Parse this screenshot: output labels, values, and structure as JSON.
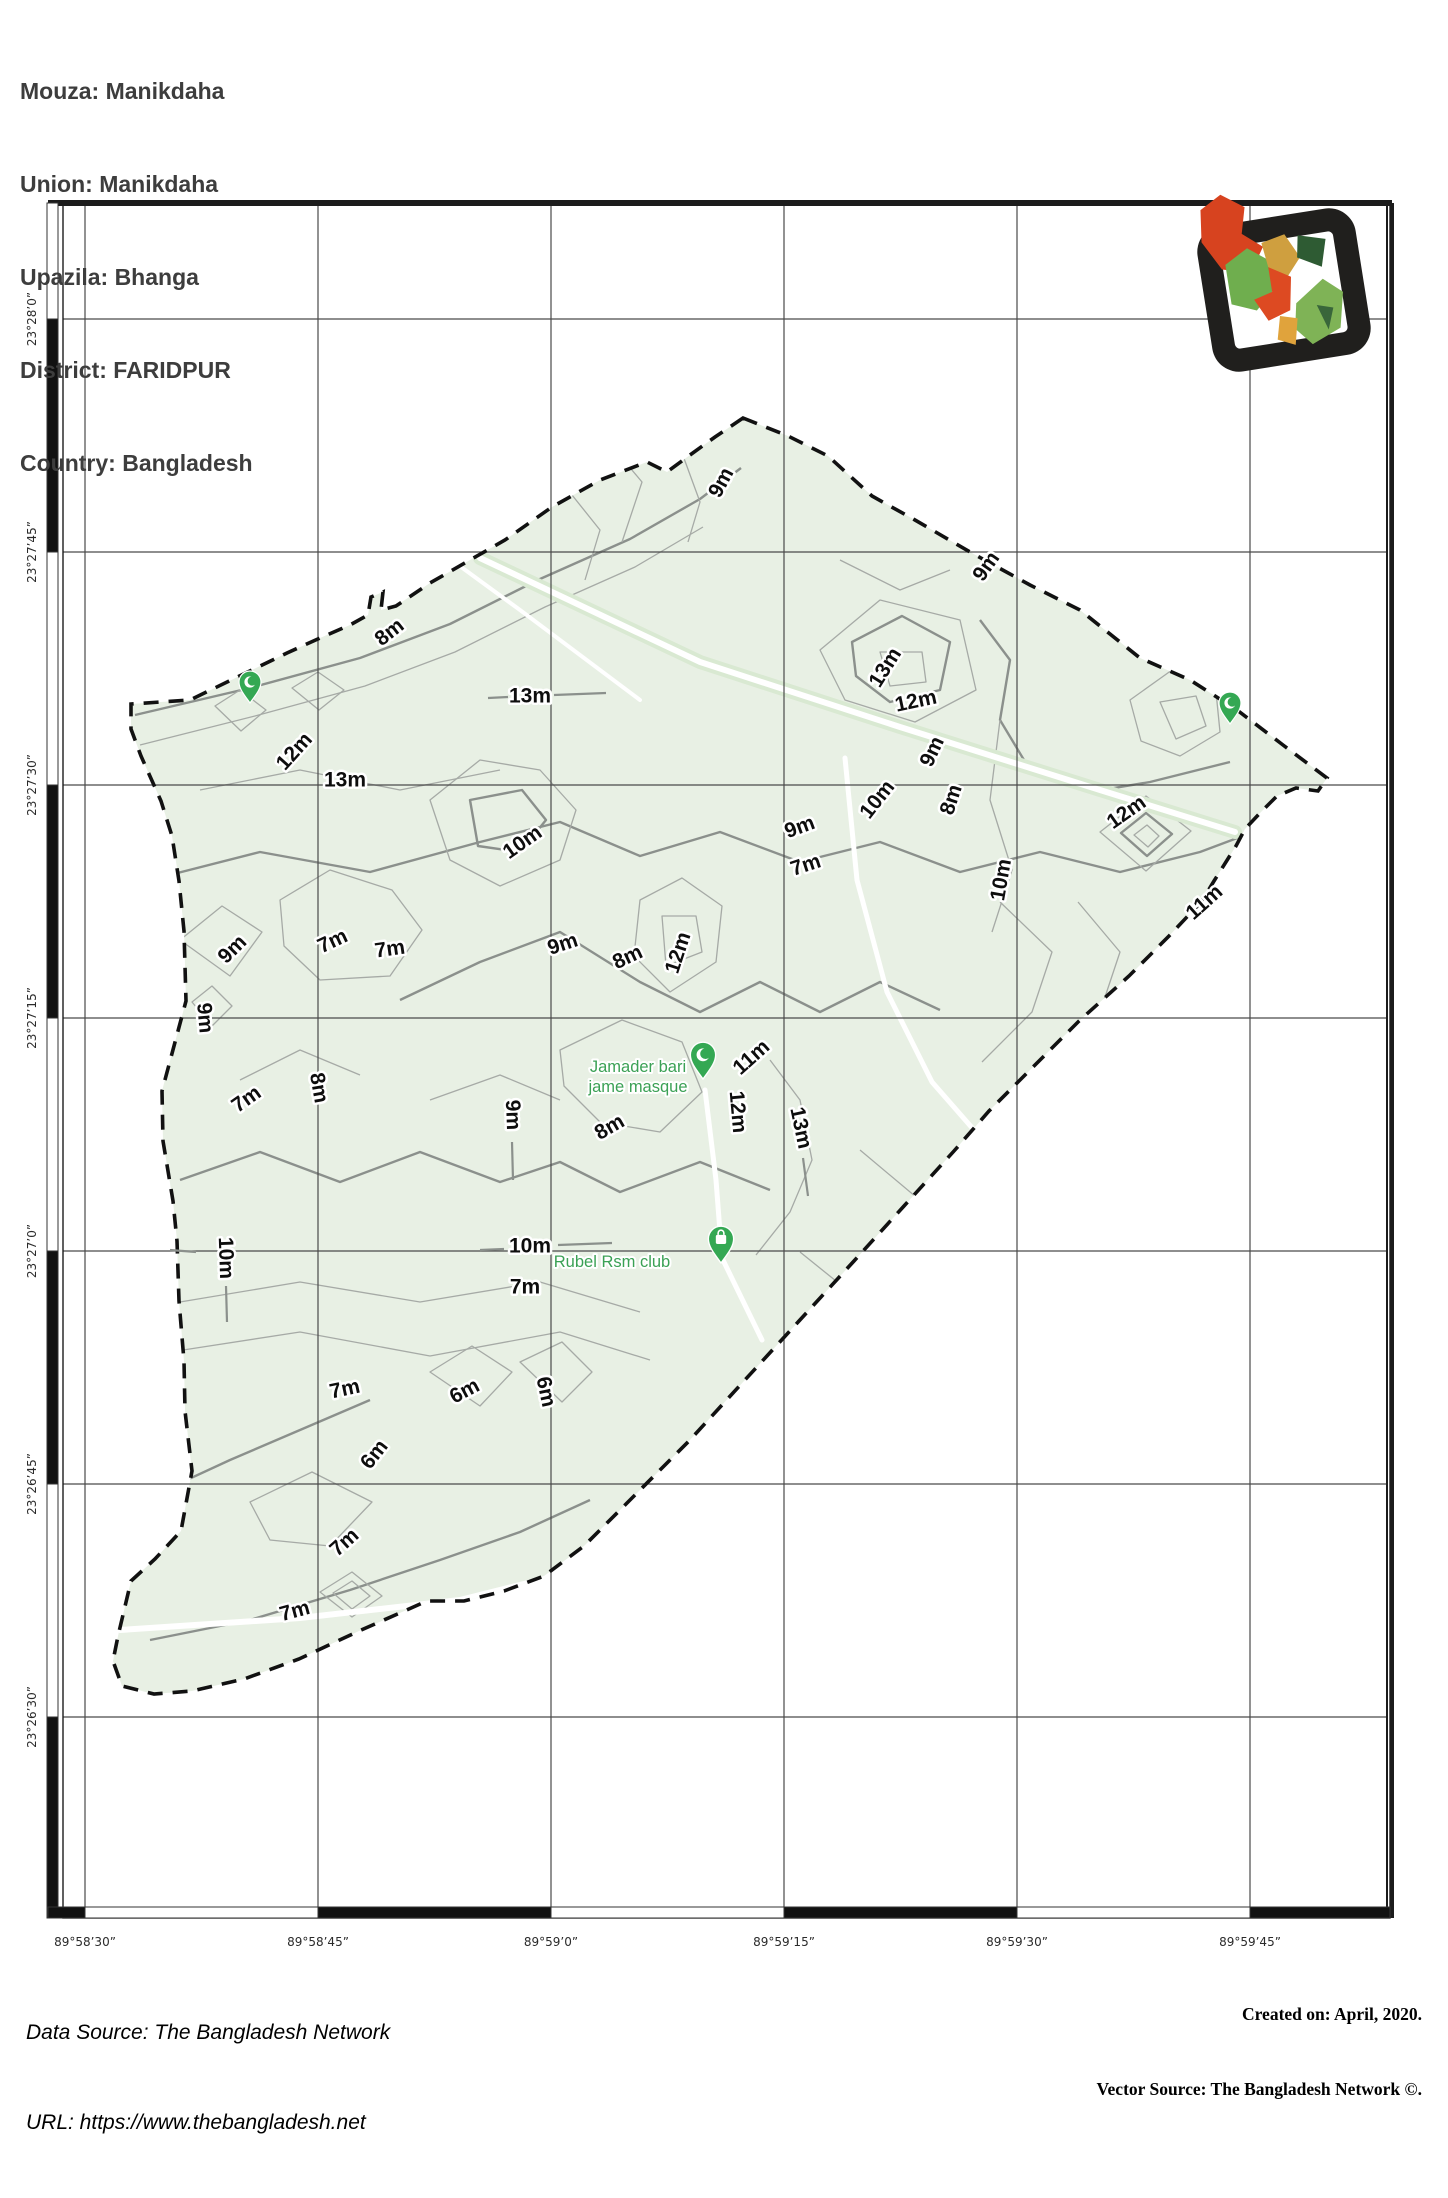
{
  "header": {
    "mouza": "Mouza: Manikdaha",
    "union": "Union: Manikdaha",
    "upazila": "Upazila: Bhanga",
    "district": "District: FARIDPUR",
    "country": "Country: Bangladesh"
  },
  "footer": {
    "data_source": "Data Source: The Bangladesh Network",
    "url": "URL: https://www.thebangladesh.net",
    "created_on": "Created on: April, 2020.",
    "vector_source": "Vector Source: The Bangladesh Network ©."
  },
  "colors": {
    "mouza_fill": "#e8f0e4",
    "contour_thin": "#a6aaa6",
    "contour_thick": "#8b908c",
    "grid": "#4a4a4a",
    "boundary": "#111111",
    "pin_green": "#34a853",
    "poi_text_green": "#3ba155",
    "frame": "#1c1c1c"
  },
  "axes": {
    "lon_ticks": [
      {
        "label": "89°58’30”",
        "x": 85
      },
      {
        "label": "89°58’45”",
        "x": 318
      },
      {
        "label": "89°59’0”",
        "x": 551
      },
      {
        "label": "89°59’15”",
        "x": 784
      },
      {
        "label": "89°59’30”",
        "x": 1017
      },
      {
        "label": "89°59’45”",
        "x": 1250
      }
    ],
    "lat_ticks": [
      {
        "label": "23°28’0”",
        "y": 319
      },
      {
        "label": "23°27’45”",
        "y": 552
      },
      {
        "label": "23°27’30”",
        "y": 785
      },
      {
        "label": "23°27’15”",
        "y": 1018
      },
      {
        "label": "23°27’0”",
        "y": 1251
      },
      {
        "label": "23°26’45”",
        "y": 1484
      },
      {
        "label": "23°26’30”",
        "y": 1717
      }
    ],
    "frame": {
      "left": 63,
      "right": 1390,
      "top": 203,
      "bottom": 1918
    }
  },
  "contour_labels": [
    {
      "t": "9m",
      "x": 722,
      "y": 483,
      "r": -62
    },
    {
      "t": "9m",
      "x": 987,
      "y": 567,
      "r": -55
    },
    {
      "t": "8m",
      "x": 390,
      "y": 633,
      "r": -38
    },
    {
      "t": "13m",
      "x": 530,
      "y": 697,
      "r": 0
    },
    {
      "t": "13m",
      "x": 886,
      "y": 668,
      "r": -58
    },
    {
      "t": "12m",
      "x": 916,
      "y": 702,
      "r": -12
    },
    {
      "t": "12m",
      "x": 295,
      "y": 752,
      "r": -48
    },
    {
      "t": "13m",
      "x": 345,
      "y": 781,
      "r": 0
    },
    {
      "t": "10m",
      "x": 523,
      "y": 843,
      "r": -35
    },
    {
      "t": "9m",
      "x": 563,
      "y": 945,
      "r": -18
    },
    {
      "t": "8m",
      "x": 628,
      "y": 958,
      "r": -25
    },
    {
      "t": "12m",
      "x": 679,
      "y": 953,
      "r": -72
    },
    {
      "t": "9m",
      "x": 800,
      "y": 828,
      "r": -20
    },
    {
      "t": "7m",
      "x": 806,
      "y": 866,
      "r": -18
    },
    {
      "t": "9m",
      "x": 933,
      "y": 752,
      "r": -65
    },
    {
      "t": "8m",
      "x": 952,
      "y": 800,
      "r": -72
    },
    {
      "t": "10m",
      "x": 878,
      "y": 800,
      "r": -52
    },
    {
      "t": "12m",
      "x": 1127,
      "y": 813,
      "r": -35
    },
    {
      "t": "11m",
      "x": 1205,
      "y": 903,
      "r": -42
    },
    {
      "t": "10m",
      "x": 1002,
      "y": 880,
      "r": -80
    },
    {
      "t": "11m",
      "x": 752,
      "y": 1058,
      "r": -42
    },
    {
      "t": "12m",
      "x": 737,
      "y": 1112,
      "r": 85
    },
    {
      "t": "13m",
      "x": 800,
      "y": 1128,
      "r": 78
    },
    {
      "t": "9m",
      "x": 233,
      "y": 950,
      "r": -45
    },
    {
      "t": "9m",
      "x": 204,
      "y": 1018,
      "r": 85
    },
    {
      "t": "7m",
      "x": 333,
      "y": 942,
      "r": -25
    },
    {
      "t": "7m",
      "x": 390,
      "y": 950,
      "r": -8
    },
    {
      "t": "7m",
      "x": 247,
      "y": 1100,
      "r": -35
    },
    {
      "t": "8m",
      "x": 318,
      "y": 1088,
      "r": 80
    },
    {
      "t": "9m",
      "x": 512,
      "y": 1115,
      "r": 88
    },
    {
      "t": "8m",
      "x": 610,
      "y": 1128,
      "r": -30
    },
    {
      "t": "10m",
      "x": 225,
      "y": 1258,
      "r": 88
    },
    {
      "t": "10m",
      "x": 530,
      "y": 1247,
      "r": 0
    },
    {
      "t": "7m",
      "x": 525,
      "y": 1288,
      "r": 0
    },
    {
      "t": "7m",
      "x": 345,
      "y": 1390,
      "r": -12
    },
    {
      "t": "6m",
      "x": 465,
      "y": 1392,
      "r": -28
    },
    {
      "t": "6m",
      "x": 545,
      "y": 1392,
      "r": 78
    },
    {
      "t": "6m",
      "x": 375,
      "y": 1455,
      "r": -52
    },
    {
      "t": "7m",
      "x": 345,
      "y": 1543,
      "r": -42
    },
    {
      "t": "7m",
      "x": 295,
      "y": 1612,
      "r": -15
    }
  ],
  "leader_lines": [
    [
      488,
      698,
      508,
      697
    ],
    [
      554,
      695,
      606,
      693
    ],
    [
      480,
      1250,
      504,
      1249
    ],
    [
      558,
      1245,
      612,
      1243
    ],
    [
      512,
      1142,
      513,
      1180
    ],
    [
      803,
      1158,
      808,
      1196
    ],
    [
      226,
      1286,
      227,
      1322
    ],
    [
      170,
      1250,
      196,
      1252
    ]
  ],
  "pois": [
    {
      "lines": [
        "Jamader bari",
        "jame masque"
      ],
      "tx": 638,
      "ty": 1072,
      "line_h": 20,
      "pin": {
        "x": 703,
        "y": 1079,
        "icon": "crescent-icon"
      }
    },
    {
      "lines": [
        "Rubel Rsm club"
      ],
      "tx": 612,
      "ty": 1267,
      "line_h": 20,
      "pin": {
        "x": 721,
        "y": 1263,
        "icon": "bag-icon"
      }
    }
  ],
  "boundary_pins": [
    {
      "x": 250,
      "y": 703,
      "icon": "crescent-icon"
    },
    {
      "x": 1230,
      "y": 724,
      "icon": "crescent-icon"
    }
  ]
}
